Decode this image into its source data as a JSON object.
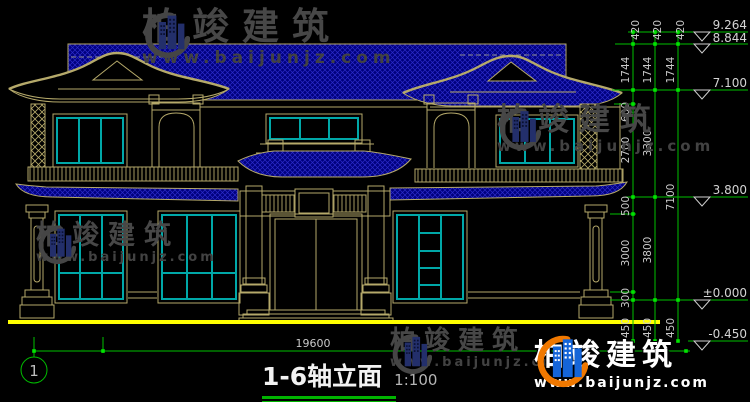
{
  "drawing": {
    "title": "1-6轴立面",
    "scale": "1:100",
    "axis_label": "1",
    "overall_width": "19600"
  },
  "dimension_chains": {
    "inner": [
      "420",
      "1744",
      "600",
      "2700",
      "500",
      "3000",
      "300",
      "450"
    ],
    "middle": [
      "420",
      "1744",
      "3300",
      "3800",
      "450"
    ],
    "outer": [
      "420",
      "1744",
      "7100",
      "450"
    ]
  },
  "elevation_markers": [
    "9.264",
    "8.844",
    "7.100",
    "3.800",
    "±0.000",
    "-0.450"
  ],
  "watermark": {
    "brand": "柏竣建筑",
    "website": "www.baijunjz.com"
  },
  "colors": {
    "line_tan": "#b5a96a",
    "line_teal": "#00a8a8",
    "dim_green": "#00bf00",
    "node_green": "#00e400",
    "roof_blue": "#00007e",
    "roof_hatch": "#2a2ac8",
    "ground_yellow": "#ffff00",
    "logo_blue": "#1565d8",
    "logo_orange": "#f07800"
  }
}
